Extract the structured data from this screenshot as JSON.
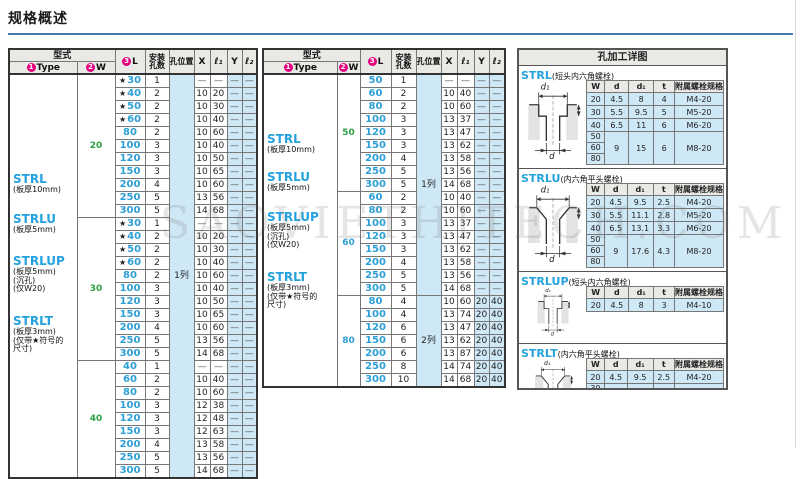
{
  "title": "规格概述",
  "watermark": "SAOVIETHITECH.COM",
  "colors": {
    "accent_rule": "#4379b2",
    "type_blue": "#25a2de",
    "size_blue": "#2e9fd6",
    "w_green": "#2f9e44",
    "cell_blue": "#cfe8f6",
    "header_gray": "#e9e9e6",
    "circle_magenta": "#e4007f"
  },
  "spec_header": {
    "type_group": "型式",
    "type_num": "1",
    "type_label": "Type",
    "w_num": "2",
    "w_label": "W",
    "l_num": "3",
    "l_label": "L",
    "holes_line1": "安装",
    "holes_line2": "孔数",
    "pos_label": "孔位置",
    "x_label": "X",
    "l1_label": "ℓ₁",
    "y_label": "Y",
    "l2_label": "ℓ₂"
  },
  "tables": [
    {
      "types": [
        {
          "name": "STRL",
          "notes": [
            "(板厚10mm)"
          ]
        },
        {
          "name": "STRLU",
          "notes": [
            "(板厚5mm)"
          ]
        },
        {
          "name": "STRLUP",
          "notes": [
            "(板厚5mm)",
            "(沉孔)",
            "(仅W20)"
          ]
        },
        {
          "name": "STRLT",
          "notes": [
            "(板厚3mm)",
            "(仅带★符号的",
            "尺寸)"
          ]
        }
      ],
      "groups": [
        {
          "w": "20",
          "color": "green",
          "rows": [
            {
              "l": "30",
              "star": true,
              "n": "1",
              "x": "—",
              "l1": "—",
              "y": "—",
              "l2": "—"
            },
            {
              "l": "40",
              "star": true,
              "n": "2",
              "x": "10",
              "l1": "20",
              "y": "—",
              "l2": "—"
            },
            {
              "l": "50",
              "star": true,
              "n": "2",
              "x": "10",
              "l1": "30",
              "y": "—",
              "l2": "—"
            },
            {
              "l": "60",
              "star": true,
              "n": "2",
              "x": "10",
              "l1": "40",
              "y": "—",
              "l2": "—"
            },
            {
              "l": "80",
              "star": false,
              "n": "2",
              "x": "10",
              "l1": "60",
              "y": "—",
              "l2": "—"
            },
            {
              "l": "100",
              "star": false,
              "n": "3",
              "x": "10",
              "l1": "40",
              "y": "—",
              "l2": "—"
            },
            {
              "l": "120",
              "star": false,
              "n": "3",
              "x": "10",
              "l1": "50",
              "y": "—",
              "l2": "—"
            },
            {
              "l": "150",
              "star": false,
              "n": "3",
              "x": "10",
              "l1": "65",
              "y": "—",
              "l2": "—"
            },
            {
              "l": "200",
              "star": false,
              "n": "4",
              "x": "10",
              "l1": "60",
              "y": "—",
              "l2": "—"
            },
            {
              "l": "250",
              "star": false,
              "n": "5",
              "x": "13",
              "l1": "56",
              "y": "—",
              "l2": "—"
            },
            {
              "l": "300",
              "star": false,
              "n": "5",
              "x": "14",
              "l1": "68",
              "y": "—",
              "l2": "—"
            }
          ]
        },
        {
          "w": "30",
          "color": "green",
          "rows": [
            {
              "l": "30",
              "star": true,
              "n": "1",
              "x": "—",
              "l1": "—",
              "y": "—",
              "l2": "—"
            },
            {
              "l": "40",
              "star": true,
              "n": "2",
              "x": "10",
              "l1": "20",
              "y": "—",
              "l2": "—"
            },
            {
              "l": "50",
              "star": true,
              "n": "2",
              "x": "10",
              "l1": "30",
              "y": "—",
              "l2": "—"
            },
            {
              "l": "60",
              "star": true,
              "n": "2",
              "x": "10",
              "l1": "40",
              "y": "—",
              "l2": "—"
            },
            {
              "l": "80",
              "star": false,
              "n": "2",
              "x": "10",
              "l1": "60",
              "y": "—",
              "l2": "—"
            },
            {
              "l": "100",
              "star": false,
              "n": "3",
              "x": "10",
              "l1": "40",
              "y": "—",
              "l2": "—"
            },
            {
              "l": "120",
              "star": false,
              "n": "3",
              "x": "10",
              "l1": "50",
              "y": "—",
              "l2": "—"
            },
            {
              "l": "150",
              "star": false,
              "n": "3",
              "x": "10",
              "l1": "65",
              "y": "—",
              "l2": "—"
            },
            {
              "l": "200",
              "star": false,
              "n": "4",
              "x": "10",
              "l1": "60",
              "y": "—",
              "l2": "—"
            },
            {
              "l": "250",
              "star": false,
              "n": "5",
              "x": "13",
              "l1": "56",
              "y": "—",
              "l2": "—"
            },
            {
              "l": "300",
              "star": false,
              "n": "5",
              "x": "14",
              "l1": "68",
              "y": "—",
              "l2": "—"
            }
          ]
        },
        {
          "w": "40",
          "color": "green",
          "rows": [
            {
              "l": "40",
              "star": false,
              "n": "1",
              "x": "—",
              "l1": "—",
              "y": "—",
              "l2": "—"
            },
            {
              "l": "60",
              "star": false,
              "n": "2",
              "x": "10",
              "l1": "40",
              "y": "—",
              "l2": "—"
            },
            {
              "l": "80",
              "star": false,
              "n": "2",
              "x": "10",
              "l1": "60",
              "y": "—",
              "l2": "—"
            },
            {
              "l": "100",
              "star": false,
              "n": "3",
              "x": "12",
              "l1": "38",
              "y": "—",
              "l2": "—"
            },
            {
              "l": "120",
              "star": false,
              "n": "3",
              "x": "12",
              "l1": "48",
              "y": "—",
              "l2": "—"
            },
            {
              "l": "150",
              "star": false,
              "n": "3",
              "x": "12",
              "l1": "63",
              "y": "—",
              "l2": "—"
            },
            {
              "l": "200",
              "star": false,
              "n": "4",
              "x": "13",
              "l1": "58",
              "y": "—",
              "l2": "—"
            },
            {
              "l": "250",
              "star": false,
              "n": "5",
              "x": "13",
              "l1": "56",
              "y": "—",
              "l2": "—"
            },
            {
              "l": "300",
              "star": false,
              "n": "5",
              "x": "14",
              "l1": "68",
              "y": "—",
              "l2": "—"
            }
          ]
        }
      ],
      "pos_cells": [
        {
          "row": 0,
          "span": 31,
          "label": "1列"
        }
      ]
    },
    {
      "types": [
        {
          "name": "STRL",
          "notes": [
            "(板厚10mm)"
          ]
        },
        {
          "name": "STRLU",
          "notes": [
            "(板厚5mm)"
          ]
        },
        {
          "name": "STRLUP",
          "notes": [
            "(板厚5mm)",
            "(沉孔)",
            "(仅W20)"
          ]
        },
        {
          "name": "STRLT",
          "notes": [
            "(板厚3mm)",
            "(仅带★符号的",
            "尺寸)"
          ]
        }
      ],
      "groups": [
        {
          "w": "50",
          "color": "green",
          "rows": [
            {
              "l": "50",
              "star": false,
              "n": "1",
              "x": "—",
              "l1": "—",
              "y": "—",
              "l2": "—"
            },
            {
              "l": "60",
              "star": false,
              "n": "2",
              "x": "10",
              "l1": "40",
              "y": "—",
              "l2": "—"
            },
            {
              "l": "80",
              "star": false,
              "n": "2",
              "x": "10",
              "l1": "60",
              "y": "—",
              "l2": "—"
            },
            {
              "l": "100",
              "star": false,
              "n": "3",
              "x": "13",
              "l1": "37",
              "y": "—",
              "l2": "—"
            },
            {
              "l": "120",
              "star": false,
              "n": "3",
              "x": "13",
              "l1": "47",
              "y": "—",
              "l2": "—"
            },
            {
              "l": "150",
              "star": false,
              "n": "3",
              "x": "13",
              "l1": "62",
              "y": "—",
              "l2": "—"
            },
            {
              "l": "200",
              "star": false,
              "n": "4",
              "x": "13",
              "l1": "58",
              "y": "—",
              "l2": "—"
            },
            {
              "l": "250",
              "star": false,
              "n": "5",
              "x": "13",
              "l1": "56",
              "y": "—",
              "l2": "—"
            },
            {
              "l": "300",
              "star": false,
              "n": "5",
              "x": "14",
              "l1": "68",
              "y": "—",
              "l2": "—"
            }
          ]
        },
        {
          "w": "60",
          "color": "blue",
          "rows": [
            {
              "l": "60",
              "star": false,
              "n": "2",
              "x": "10",
              "l1": "40",
              "y": "—",
              "l2": "—"
            },
            {
              "l": "80",
              "star": false,
              "n": "2",
              "x": "10",
              "l1": "60",
              "y": "—",
              "l2": "—"
            },
            {
              "l": "100",
              "star": false,
              "n": "3",
              "x": "13",
              "l1": "37",
              "y": "—",
              "l2": "—"
            },
            {
              "l": "120",
              "star": false,
              "n": "3",
              "x": "13",
              "l1": "47",
              "y": "—",
              "l2": "—"
            },
            {
              "l": "150",
              "star": false,
              "n": "3",
              "x": "13",
              "l1": "62",
              "y": "—",
              "l2": "—"
            },
            {
              "l": "200",
              "star": false,
              "n": "4",
              "x": "13",
              "l1": "58",
              "y": "—",
              "l2": "—"
            },
            {
              "l": "250",
              "star": false,
              "n": "5",
              "x": "13",
              "l1": "56",
              "y": "—",
              "l2": "—"
            },
            {
              "l": "300",
              "star": false,
              "n": "5",
              "x": "14",
              "l1": "68",
              "y": "—",
              "l2": "—"
            }
          ]
        },
        {
          "w": "80",
          "color": "blue",
          "rows": [
            {
              "l": "80",
              "star": false,
              "n": "4",
              "x": "10",
              "l1": "60",
              "y": "20",
              "l2": "40"
            },
            {
              "l": "100",
              "star": false,
              "n": "4",
              "x": "13",
              "l1": "74",
              "y": "20",
              "l2": "40"
            },
            {
              "l": "120",
              "star": false,
              "n": "6",
              "x": "13",
              "l1": "47",
              "y": "20",
              "l2": "40"
            },
            {
              "l": "150",
              "star": false,
              "n": "6",
              "x": "13",
              "l1": "62",
              "y": "20",
              "l2": "40"
            },
            {
              "l": "200",
              "star": false,
              "n": "6",
              "x": "13",
              "l1": "87",
              "y": "20",
              "l2": "40"
            },
            {
              "l": "250",
              "star": false,
              "n": "8",
              "x": "14",
              "l1": "74",
              "y": "20",
              "l2": "40"
            },
            {
              "l": "300",
              "star": false,
              "n": "10",
              "x": "14",
              "l1": "68",
              "y": "20",
              "l2": "40"
            }
          ]
        }
      ],
      "pos_cells": [
        {
          "row": 0,
          "span": 17,
          "label": "1列"
        },
        {
          "row": 17,
          "span": 7,
          "label": "2列"
        }
      ]
    }
  ],
  "holes_panel": {
    "title": "孔加工详图",
    "col_headers": [
      "W",
      "d",
      "d₁",
      "t",
      "附属螺栓规格"
    ],
    "diagram": {
      "top_label": "d₁",
      "bottom_label": "d"
    },
    "sections": [
      {
        "name": "STRL",
        "note": "(短头内六角螺栓)",
        "diagram": "counterbore",
        "rows": [
          {
            "w": [
              "20"
            ],
            "d": "4.5",
            "d1": "8",
            "t": "4",
            "spec": "M4-20"
          },
          {
            "w": [
              "30"
            ],
            "d": "5.5",
            "d1": "9.5",
            "t": "5",
            "spec": "M5-20"
          },
          {
            "w": [
              "40"
            ],
            "d": "6.5",
            "d1": "11",
            "t": "6",
            "spec": "M6-20"
          },
          {
            "w": [
              "50",
              "60",
              "80"
            ],
            "d": "9",
            "d1": "15",
            "t": "6",
            "spec": "M8-20"
          }
        ]
      },
      {
        "name": "STRLU",
        "note": "(内六角平头螺栓)",
        "diagram": "countersink",
        "rows": [
          {
            "w": [
              "20"
            ],
            "d": "4.5",
            "d1": "9.5",
            "t": "2.5",
            "spec": "M4-20"
          },
          {
            "w": [
              "30"
            ],
            "d": "5.5",
            "d1": "11.1",
            "t": "2.8",
            "spec": "M5-20"
          },
          {
            "w": [
              "40"
            ],
            "d": "6.5",
            "d1": "13.1",
            "t": "3.3",
            "spec": "M6-20"
          },
          {
            "w": [
              "50",
              "60",
              "80"
            ],
            "d": "9",
            "d1": "17.6",
            "t": "4.3",
            "spec": "M8-20"
          }
        ]
      },
      {
        "name": "STRLUP",
        "note": "(短头内六角螺栓)",
        "diagram": "counterbore",
        "rows": [
          {
            "w": [
              "20"
            ],
            "d": "4.5",
            "d1": "8",
            "t": "3",
            "spec": "M4-10"
          }
        ]
      },
      {
        "name": "STRLT",
        "note": "(内六角平头螺栓)",
        "diagram": "countersink",
        "rows": [
          {
            "w": [
              "20"
            ],
            "d": "4.5",
            "d1": "9.5",
            "t": "2.5",
            "spec": "M4-20"
          },
          {
            "w": [
              "30",
              "40"
            ],
            "d": "5.5",
            "d1": "11.1",
            "t": "2.8",
            "spec": "M5-20"
          }
        ]
      }
    ]
  }
}
